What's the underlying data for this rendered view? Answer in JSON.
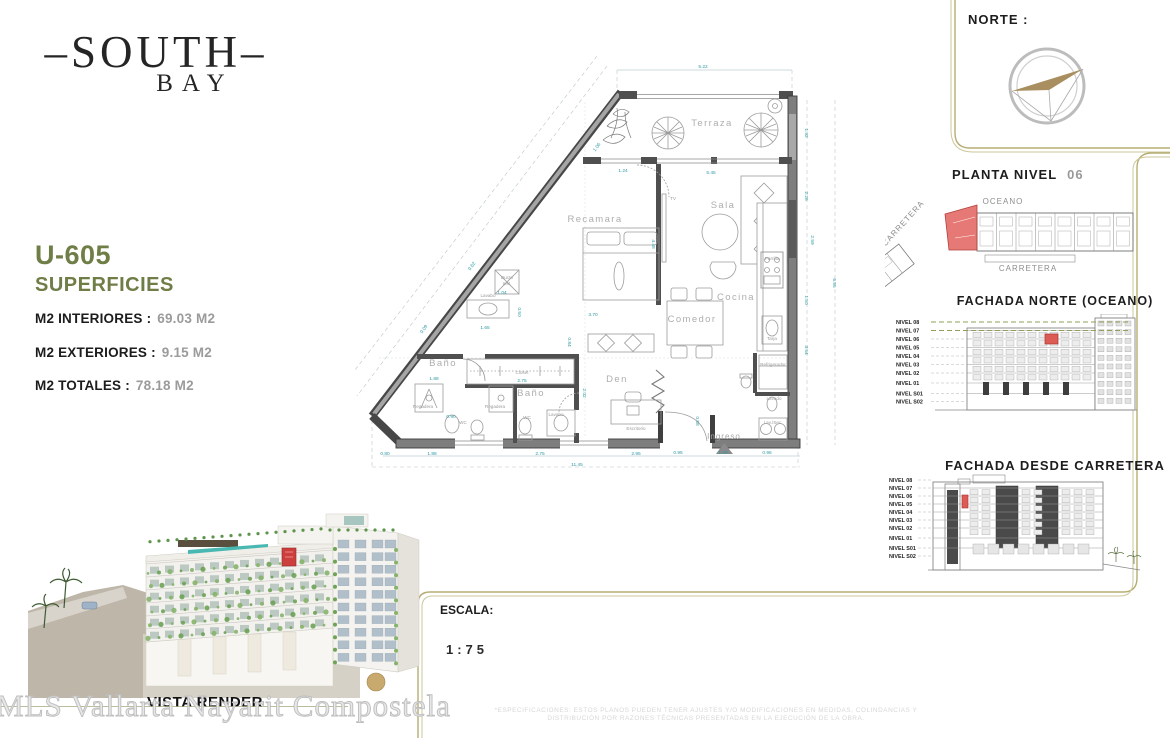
{
  "logo": {
    "line1": "–SOUTH–",
    "line2": "BAY"
  },
  "unit_info": {
    "unit": "U-605",
    "section_title": "SUPERFICIES",
    "rows": [
      {
        "label": "M2 INTERIORES :",
        "value": "69.03  M2"
      },
      {
        "label": "M2 EXTERIORES :",
        "value": "9.15  M2"
      },
      {
        "label": "M2 TOTALES :",
        "value": "78.18  M2"
      }
    ]
  },
  "north": {
    "label": "NORTE :"
  },
  "site_plan": {
    "title": "PLANTA  NIVEL",
    "level": "06",
    "labels": [
      {
        "t": "OCEANO",
        "x": 118,
        "y": 21
      },
      {
        "t": "CARRETERA",
        "x": 143,
        "y": 88
      },
      {
        "t": "CARRETERA",
        "x": 20,
        "y": 42,
        "r": -48
      }
    ]
  },
  "elevation_north": {
    "title": "FACHADA  NORTE  (OCEANO)",
    "levels": [
      "NIVEL 08",
      "NIVEL 07",
      "NIVEL 06",
      "NIVEL 05",
      "NIVEL 04",
      "NIVEL 03",
      "NIVEL 02",
      "NIVEL 01",
      "NIVEL S01",
      "NIVEL S02"
    ],
    "highlight_level": "NIVEL 06"
  },
  "elevation_road": {
    "title": "FACHADA  DESDE  CARRETERA",
    "levels": [
      "NIVEL 08",
      "NIVEL 07",
      "NIVEL 06",
      "NIVEL 05",
      "NIVEL 04",
      "NIVEL 03",
      "NIVEL 02",
      "NIVEL 01",
      "NIVEL S01",
      "NIVEL S02"
    ],
    "highlight_level": "NIVEL 06"
  },
  "render": {
    "caption": "VISTA RENDER"
  },
  "scale": {
    "label": "ESCALA:",
    "value": "1:75"
  },
  "watermark": "MLS Vallarta Nayarit Compostela",
  "disclaimer": {
    "line1": "*ESPECIFICACIONES: ESTOS PLANOS PUEDEN TENER AJUSTES Y/O MODIFICACIONES EN MEDIDAS, COLINDANCIAS Y",
    "line2": "DISTRIBUCIÓN POR RAZONES TÉCNICAS PRESENTADAS EN LA EJECUCIÓN DE LA OBRA."
  },
  "floorplan": {
    "rooms": [
      {
        "t": "Terraza",
        "x": 357,
        "y": 78
      },
      {
        "t": "Sala",
        "x": 368,
        "y": 160
      },
      {
        "t": "Recamara",
        "x": 240,
        "y": 174
      },
      {
        "t": "Cocina",
        "x": 381,
        "y": 252
      },
      {
        "t": "Comedor",
        "x": 337,
        "y": 274
      },
      {
        "t": "Den",
        "x": 262,
        "y": 334
      },
      {
        "t": "Baño",
        "x": 88,
        "y": 318
      },
      {
        "t": "Baño",
        "x": 176,
        "y": 348
      }
    ],
    "fixtures": [
      {
        "t": "TV",
        "x": 318,
        "y": 152
      },
      {
        "t": "Ducto",
        "x": 152,
        "y": 231
      },
      {
        "t": "Inst.",
        "x": 152,
        "y": 237
      },
      {
        "t": "Lavabo",
        "x": 133,
        "y": 249
      },
      {
        "t": "Closet",
        "x": 167,
        "y": 326
      },
      {
        "t": "Regadera",
        "x": 68,
        "y": 360
      },
      {
        "t": "Regadera",
        "x": 140,
        "y": 360
      },
      {
        "t": "WC",
        "x": 108,
        "y": 376
      },
      {
        "t": "WC",
        "x": 172,
        "y": 371
      },
      {
        "t": "Lavabo",
        "x": 201,
        "y": 368
      },
      {
        "t": "Escritorio",
        "x": 281,
        "y": 382
      },
      {
        "t": "Parrilla",
        "x": 417,
        "y": 212
      },
      {
        "t": "Tarja",
        "x": 417,
        "y": 292
      },
      {
        "t": "Refrigerador",
        "x": 418,
        "y": 318
      },
      {
        "t": "Lavado",
        "x": 419,
        "y": 352
      },
      {
        "t": "Lav./Sec.",
        "x": 418,
        "y": 376
      }
    ],
    "ingreso_label": {
      "t": "Ingreso",
      "x": 369,
      "y": 391
    },
    "dims": [
      {
        "t": "5.22",
        "x": 348,
        "y": 20
      },
      {
        "t": "1.92",
        "x": 450,
        "y": 85,
        "r": 90
      },
      {
        "t": "2.26",
        "x": 450,
        "y": 148,
        "r": 90
      },
      {
        "t": "2.59",
        "x": 456,
        "y": 192,
        "r": 90
      },
      {
        "t": "1.50",
        "x": 450,
        "y": 252,
        "r": 90
      },
      {
        "t": "3.54",
        "x": 450,
        "y": 302,
        "r": 90
      },
      {
        "t": "6.55",
        "x": 478,
        "y": 235,
        "r": 90
      },
      {
        "t": "0.80",
        "x": 30,
        "y": 407
      },
      {
        "t": "1.88",
        "x": 77,
        "y": 407
      },
      {
        "t": "2.75",
        "x": 185,
        "y": 407
      },
      {
        "t": "2.95",
        "x": 281,
        "y": 407
      },
      {
        "t": "0.95",
        "x": 323,
        "y": 406
      },
      {
        "t": "1.29",
        "x": 368,
        "y": 406
      },
      {
        "t": "0.96",
        "x": 412,
        "y": 406
      },
      {
        "t": "11.45",
        "x": 222,
        "y": 418
      },
      {
        "t": "9.62",
        "x": 118,
        "y": 219,
        "r": -54
      },
      {
        "t": "9.09",
        "x": 70,
        "y": 282,
        "r": -54
      },
      {
        "t": "1.06",
        "x": 243,
        "y": 100,
        "r": -54
      },
      {
        "t": "1.24",
        "x": 268,
        "y": 124
      },
      {
        "t": "5.45",
        "x": 356,
        "y": 126
      },
      {
        "t": "1.04",
        "x": 147,
        "y": 246
      },
      {
        "t": "1.65",
        "x": 130,
        "y": 281
      },
      {
        "t": "0.50",
        "x": 163,
        "y": 264,
        "r": 90
      },
      {
        "t": "3.70",
        "x": 238,
        "y": 268
      },
      {
        "t": "4.48",
        "x": 297,
        "y": 196,
        "r": 90
      },
      {
        "t": "0.84",
        "x": 213,
        "y": 294,
        "r": 90
      },
      {
        "t": "2.75",
        "x": 167,
        "y": 334
      },
      {
        "t": "1.88",
        "x": 79,
        "y": 332
      },
      {
        "t": "0.90",
        "x": 96,
        "y": 370
      },
      {
        "t": "0.58",
        "x": 341,
        "y": 373,
        "r": 90
      },
      {
        "t": "2.02",
        "x": 228,
        "y": 345,
        "r": 90
      }
    ]
  },
  "colors": {
    "accent_olive": "#6f7d46",
    "gold_line": "#b5ad72",
    "highlight_red": "#dd5b55",
    "dim_teal": "#2f9ba5",
    "value_gray": "#9b9b9b"
  }
}
